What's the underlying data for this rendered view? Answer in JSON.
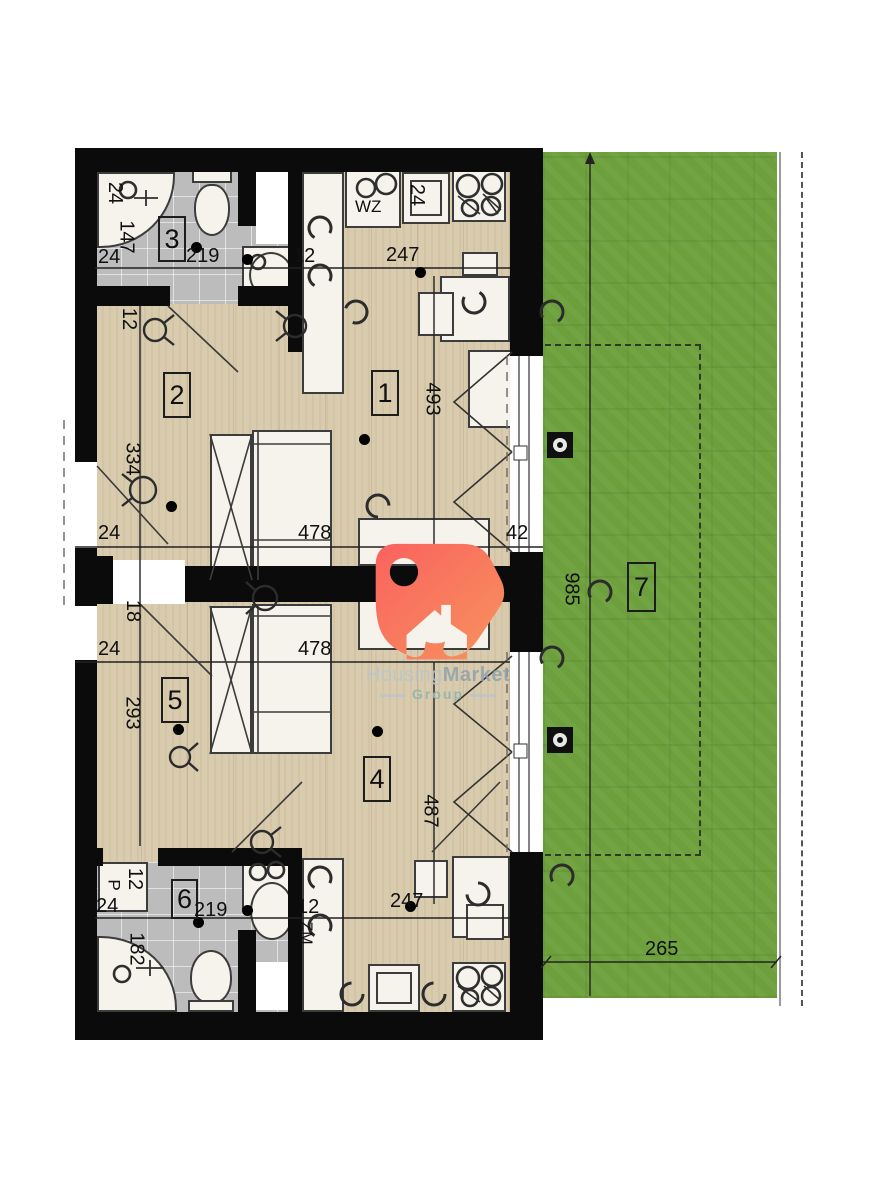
{
  "plan_title": "two-unit floor plan with garden",
  "logo": {
    "brand_light": "Housing",
    "brand_bold": "Market",
    "subtitle": "Group"
  },
  "rooms": {
    "r1": "1",
    "r2": "2",
    "r3": "3",
    "r4": "4",
    "r5": "5",
    "r6": "6",
    "r7": "7"
  },
  "fixtures": {
    "kitchen_sink_top": "WZ",
    "dishwasher_bottom": "ZM",
    "washing_machine": "P"
  },
  "dims": {
    "shower_top": "24",
    "bath_top_height": "147",
    "bath_top_left_wall": "24",
    "bath_top_width": "219",
    "bath_top_door": "12",
    "hall_top_wall": "12",
    "kitchen_top_counter": "24",
    "kitchen_top_width": "247",
    "living_top_height": "493",
    "entry_top_offset": "334",
    "bedroom_top_left_wall": "24",
    "bedroom_top_width": "478",
    "window_jamb": "42",
    "middle_door": "18",
    "bedroom_bottom_left_wall": "24",
    "bedroom_bottom_width": "478",
    "bedroom_bottom_height": "293",
    "living_bottom_height": "487",
    "washer_width": "12",
    "bath_bottom_left_wall": "24",
    "bath_bottom_width": "219",
    "shower_bottom_height": "182",
    "bath_bottom_door": "12",
    "kitchen_bottom_width": "247",
    "garden_depth": "985",
    "garden_width": "265"
  },
  "colors": {
    "wall": "#0b0b0b",
    "wood_floor": "#d9cbae",
    "tile_floor": "#bcbcbc",
    "grass": "#6da03c",
    "logo_gradient_start": "#fa625f",
    "logo_gradient_end": "#f7935c",
    "brand_light": "#b7c4cd",
    "brand_bold": "#8da2ad",
    "brand_subtitle": "#8fb5ad"
  }
}
